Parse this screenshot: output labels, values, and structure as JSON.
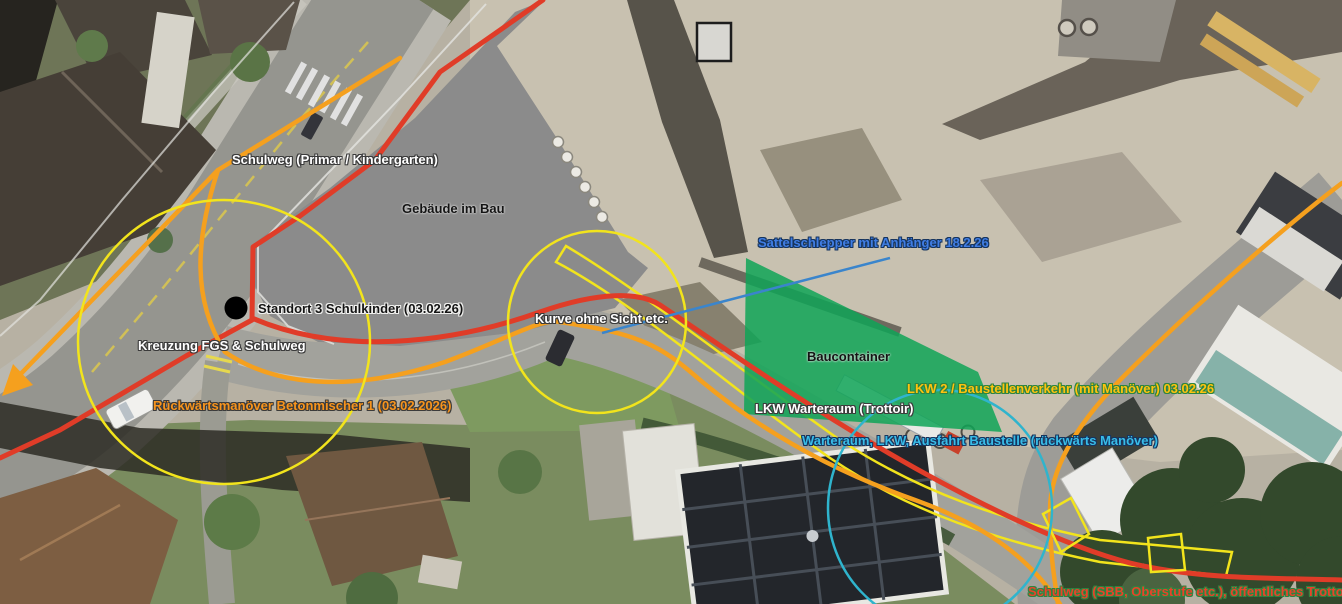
{
  "colors": {
    "route_red": "#e03c28",
    "route_orange": "#f5a01e",
    "highlight_yellow": "#f2e41c",
    "zone_green": "#0fa457",
    "zone_cyan": "#2fb4cd",
    "connector_blue": "#3a85cc",
    "label_blue": "#3f7de4",
    "label_cyan": "#38bce8",
    "label_orange": "#f7941d",
    "label_gold": "#ffc20e",
    "label_red": "#e8432a",
    "halo_green": "#2e8540"
  },
  "labels": {
    "schulweg_primar": "Schulweg (Primar / Kindergarten)",
    "gebaeude_im_bau": "Gebäude im Bau",
    "sattelschlepper": "Sattelschlepper mit Anhänger 18.2.26",
    "standort_schulkinder": "Standort 3 Schulkinder (03.02.26)",
    "kurve_ohne_sicht": "Kurve ohne Sicht etc.",
    "kreuzung_fgs": "Kreuzung FGS & Schulweg",
    "baucontainer": "Baucontainer",
    "rueckwaertsmanoever": "Rückwärtsmanöver Betonmischer 1 (03.02.2026)",
    "lkw2_baustellenverkehr": "LKW 2 / Baustellenverkehr (mit Manöver) 03.02.26",
    "lkw_warteraum": "LKW Warteraum (Trottoir)",
    "warteraum_ausfahrt": "Warteraum, LKW, Ausfahrt Baustelle (rückwärts Manöver)",
    "schulweg_sbb": "Schulweg (SBB, Oberstufe etc.), öffentliches Trottoir"
  },
  "icons": {
    "standort_marker": "black-dot-marker",
    "direction_arrow": "orange-arrow-down-left"
  }
}
